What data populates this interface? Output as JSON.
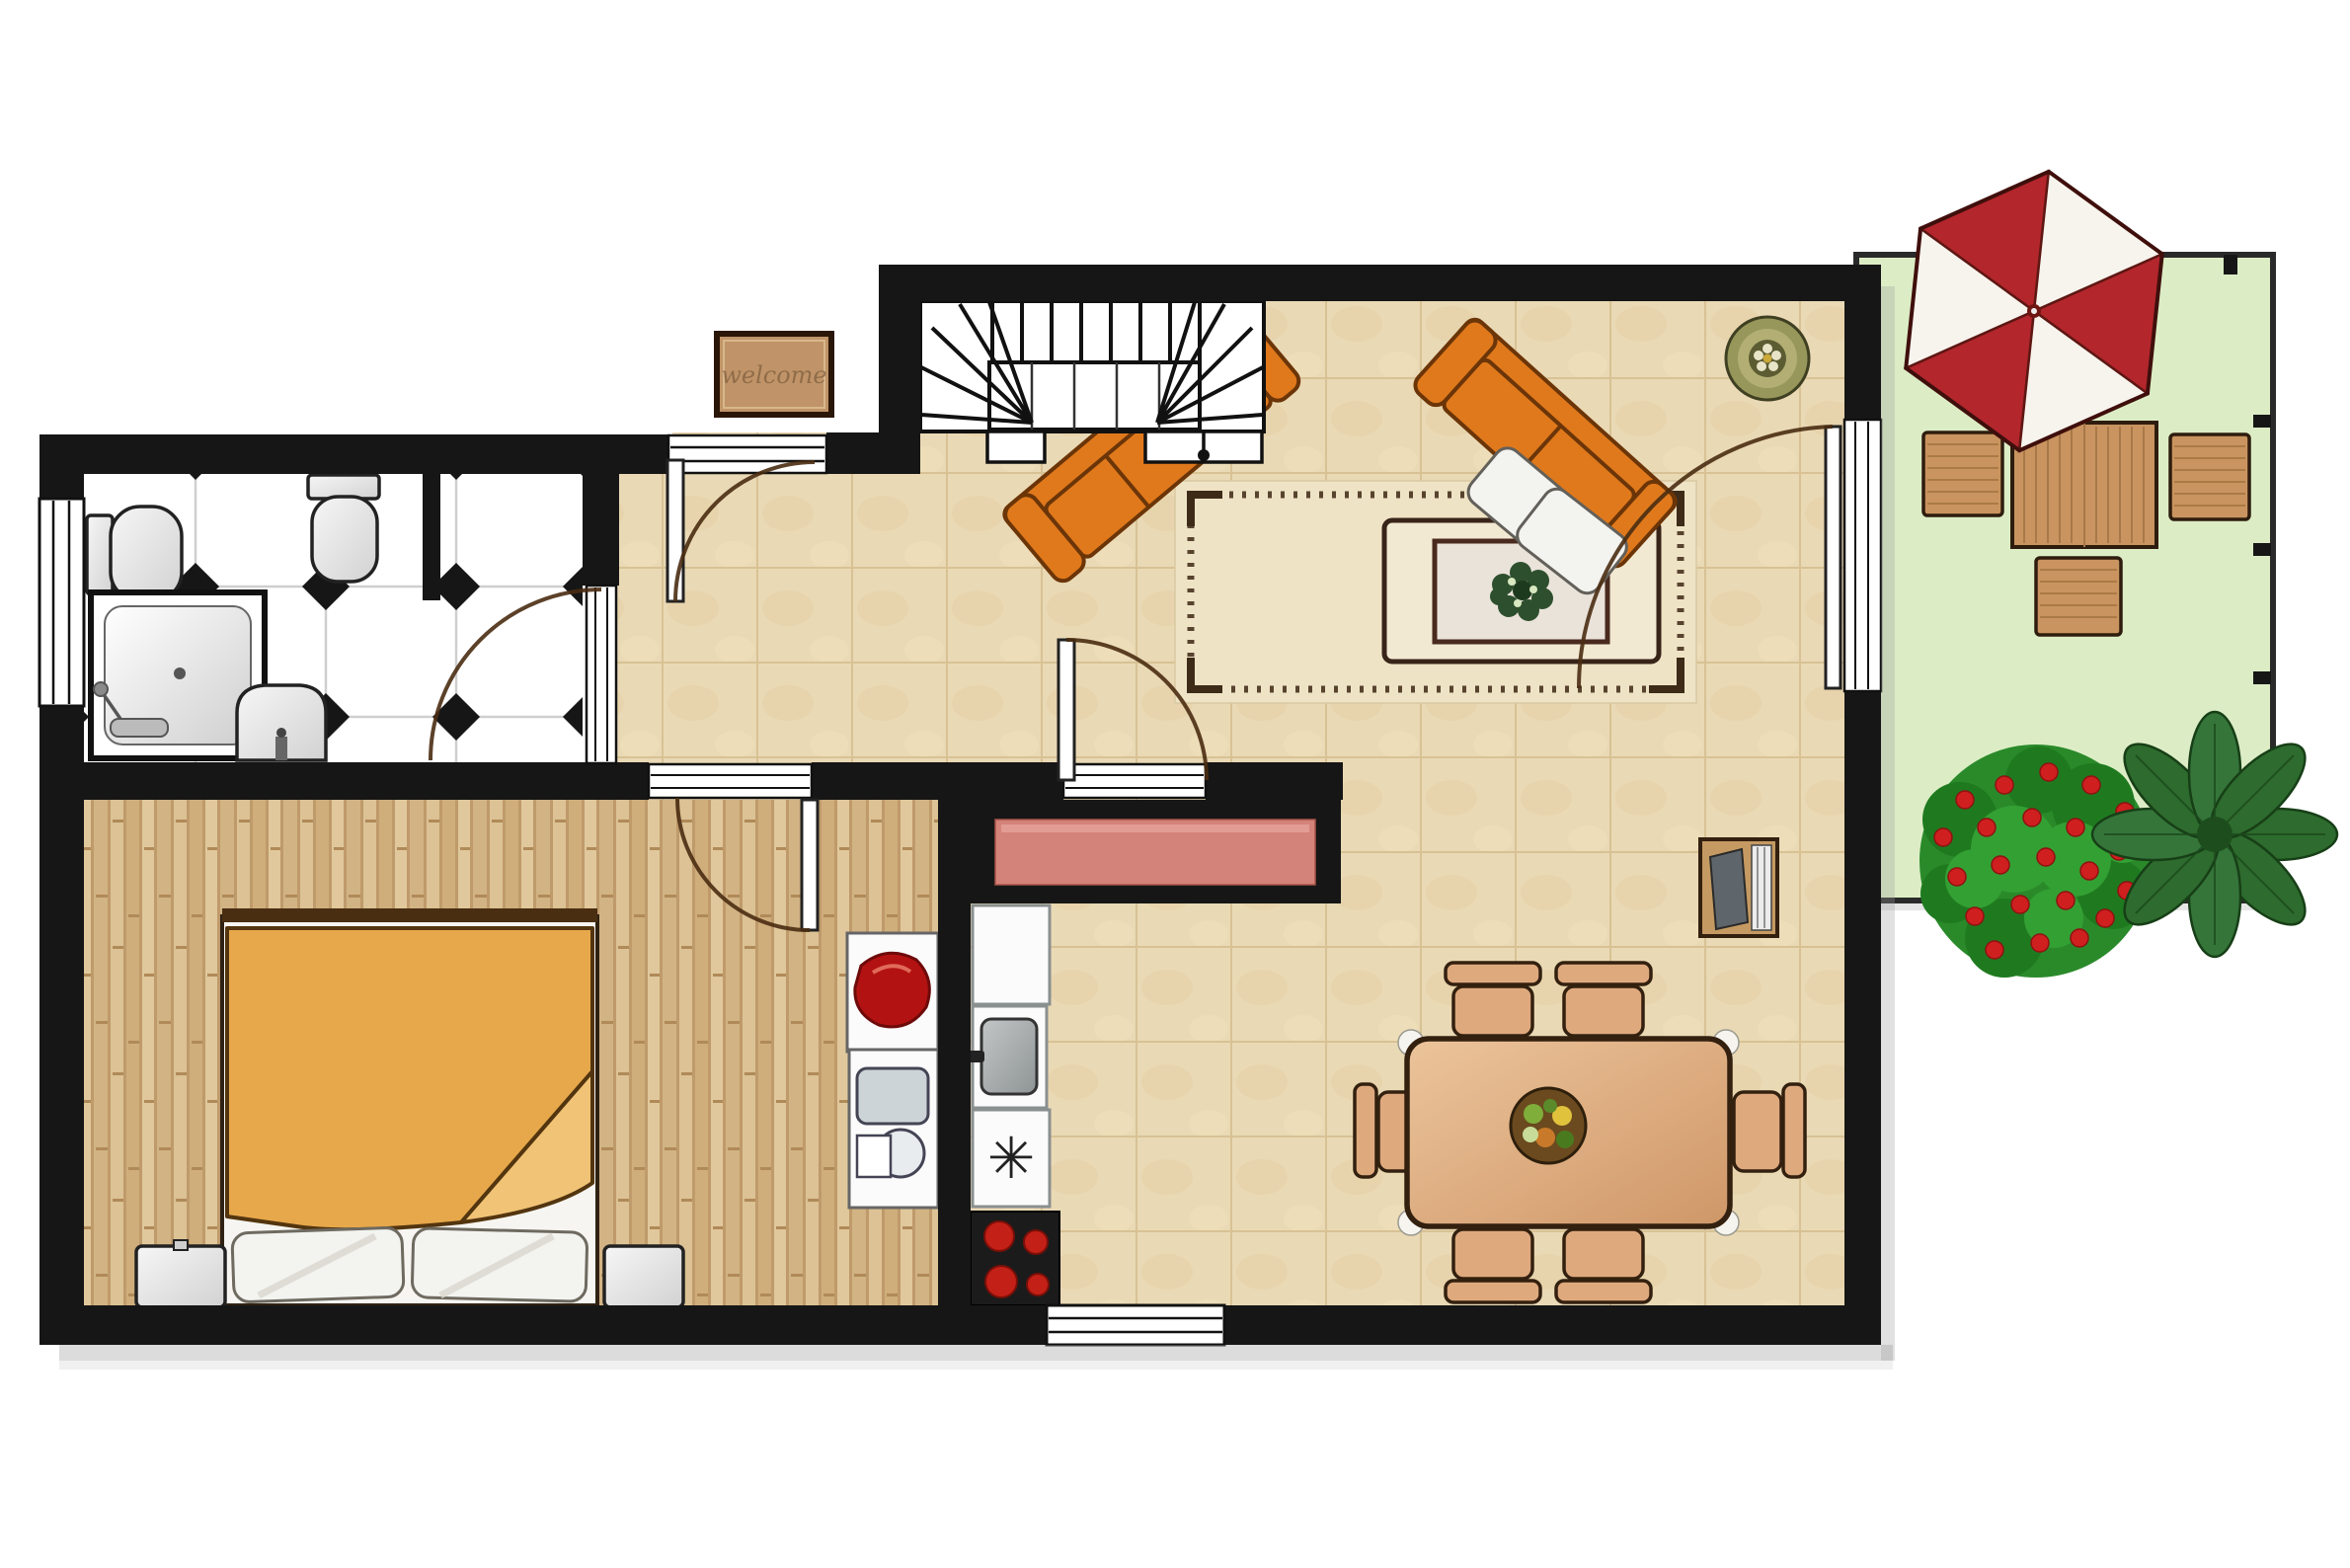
{
  "doormat": {
    "label": "welcome"
  },
  "kitchen": {
    "freezer_symbol": "✳"
  },
  "colors": {
    "wall": "#161616",
    "exterior_bg": "#ffffff",
    "tile_floor": "#ead9b5",
    "tile_grid": "#d8c294",
    "wood_floor": "#d6b98b",
    "bath_floor": "#ffffff",
    "bath_diamond": "#161616",
    "patio_grass": "#dcedc5",
    "patio_border": "#2a2a2a",
    "umbrella_red": "#b3262c",
    "umbrella_white": "#f7f4ee",
    "patio_wood": "#c9945f",
    "sofa_orange": "#e0791c",
    "sofa_outline": "#6b3508",
    "pillow_white": "#f3f3f0",
    "rug_base": "#efe3c5",
    "rug_stitch": "#57432e",
    "coffee_table_frame": "#f2e9d2",
    "coffee_table_inner": "#eae3da",
    "wreath_green": "#2d4f2d",
    "plant_olive": "#97975c",
    "tv_cabinet_wood": "#c59a62",
    "dining_table_wood": "#e3b183",
    "dining_chair_wood": "#dfa97e",
    "wood_outline": "#33200f",
    "fruit_bowl": "#6b4a1f",
    "bed_blanket": "#e7a84b",
    "bed_blanket_fold": "#f1c376",
    "bed_outline": "#53350f",
    "nightstand_gray": "#d5d5d5",
    "counter_salmon": "#d4837a",
    "appliance_white": "#fbfbfb",
    "stove_black": "#1b1b1b",
    "burner_red": "#c32017",
    "laundry_red": "#b31212",
    "door_arc_brown": "#4a2c12",
    "threshold_white": "#ffffff",
    "bush_green": "#2a8a2a",
    "bush_flower_red": "#cf1f1f",
    "leaf_plant_green": "#2e6b2e",
    "mat_brown": "#c09468",
    "mat_border": "#2a1607"
  }
}
